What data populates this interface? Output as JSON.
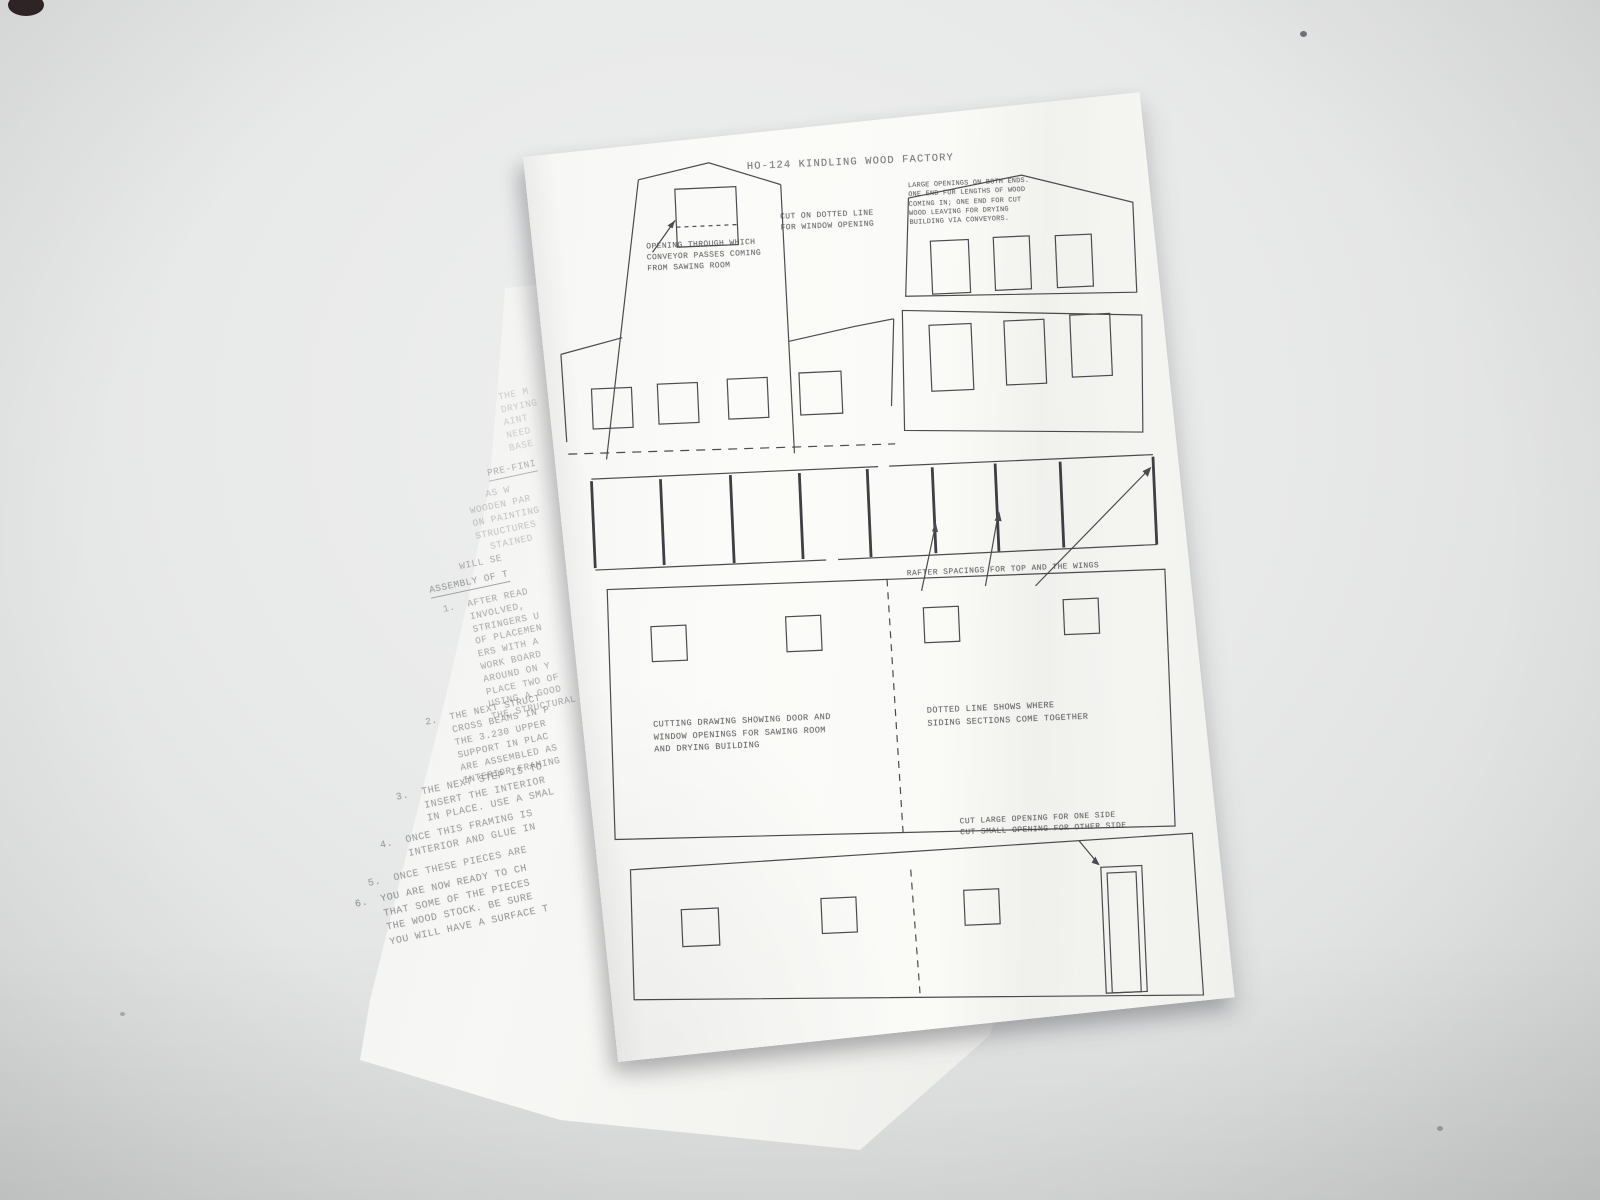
{
  "colors": {
    "background": "#e9eaea",
    "paper": "#fafaf8",
    "ink": "#4c4c50",
    "faint_ink": "#4e4e52"
  },
  "top_sheet": {
    "title": "HO-124 KINDLING WOOD FACTORY",
    "conveyor_note": [
      "OPENING THROUGH WHICH",
      "CONVEYOR PASSES COMING",
      "FROM SAWING ROOM"
    ],
    "window_note": [
      "CUT ON DOTTED LINE",
      "FOR WINDOW OPENING"
    ],
    "openings_note": [
      "LARGE OPENINGS ON BOTH ENDS.",
      "ONE END FOR LENGTHS OF WOOD",
      "COMING IN; ONE END FOR CUT",
      "WOOD LEAVING FOR DRYING",
      "BUILDING VIA CONVEYORS."
    ],
    "rafter_note": "RAFTER SPACINGS FOR TOP AND THE WINGS",
    "cutting_note": [
      "CUTTING DRAWING SHOWING DOOR AND",
      "WINDOW OPENINGS FOR SAWING ROOM",
      "AND DRYING BUILDING"
    ],
    "dotted_note": [
      "DOTTED LINE SHOWS WHERE",
      "SIDING SECTIONS COME TOGETHER"
    ],
    "door_note": [
      "CUT LARGE OPENING FOR ONE SIDE",
      "CUT SMALL OPENING FOR OTHER SIDE"
    ]
  },
  "under_sheet": {
    "blocks": [
      {
        "lines": [
          "THE M",
          "DRYING",
          "AINT",
          "NEED",
          "BASE"
        ]
      },
      {
        "lines": [
          "PRE-FINI"
        ]
      },
      {
        "lines": [
          "   AS W",
          "WOODEN PAR",
          "ON PAINTING",
          "STRUCTURES",
          "  STAINED"
        ]
      },
      {
        "lines": [
          "  WILL SE"
        ]
      },
      {
        "lines": [
          "ASSEMBLY OF T"
        ]
      },
      {
        "lines": [
          "1.  AFTER READ",
          "    INVOLVED,",
          "    STRINGERS U",
          "    OF PLACEMEN",
          "    ERS WITH A",
          "    WORK BOARD",
          "    AROUND ON Y",
          "    PLACE TWO OF",
          "    USING A GOOD",
          "    THE STRUCTURAL"
        ]
      },
      {
        "lines": [
          "2.  THE NEXT STRUCT",
          "    CROSS BEAMS IN P",
          "    THE 3.230 UPPER",
          "    SUPPORT IN PLAC",
          "    ARE ASSEMBLED AS",
          "    INTERIOR FRAMING"
        ]
      },
      {
        "lines": [
          "3.  THE NEXT STEP IS TO",
          "    INSERT THE INTERIOR",
          "    IN PLACE. USE A SMAL"
        ]
      },
      {
        "lines": [
          "4.  ONCE THIS FRAMING IS",
          "    INTERIOR AND GLUE IN"
        ]
      },
      {
        "lines": [
          "5.  ONCE THESE PIECES ARE"
        ]
      },
      {
        "lines": [
          "6.  YOU ARE NOW READY TO CH",
          "    THAT SOME OF THE PIECES",
          "    THE WOOD STOCK. BE SURE",
          "    YOU WILL HAVE A SURFACE T"
        ]
      }
    ]
  }
}
